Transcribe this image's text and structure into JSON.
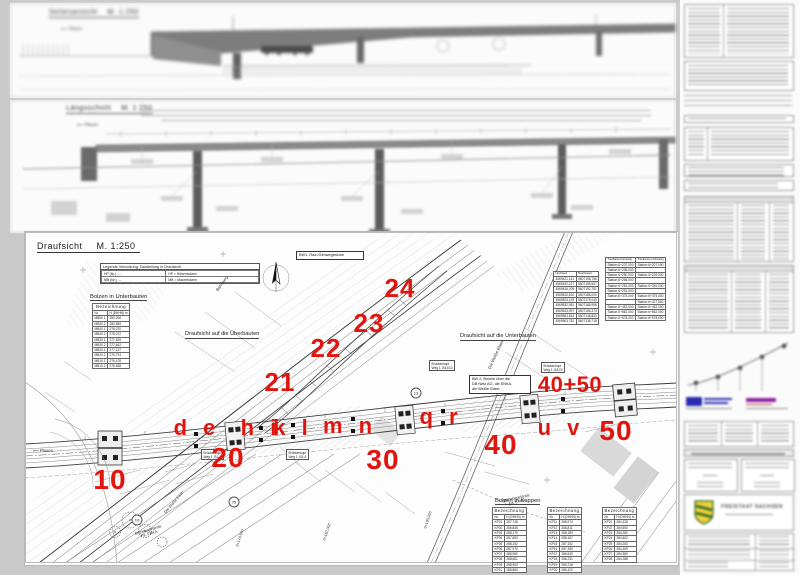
{
  "colors": {
    "red": "#e2140e",
    "paper": "#fbfbfb",
    "line": "#444444",
    "shield_green": "#2d6b1e",
    "shield_yellow": "#f0d040",
    "logo_blue": "#2b2bb0",
    "logo_purple": "#8a1f9e"
  },
  "sheet_side": {
    "title": "Seitenansicht",
    "scale": "M. 1:250",
    "direction": "Plauen"
  },
  "sheet_long": {
    "title": "Längsschnitt",
    "scale": "M. 1:250",
    "direction": "Plauen"
  },
  "plan": {
    "title": "Draufsicht",
    "scale": "M. 1:250",
    "legend": {
      "title": "Legende Verbolzung: Darstellung in Draufsicht",
      "rows": [
        [
          "HP (Nr.) .....",
          "HP   =   Höhenbolzen"
        ],
        [
          "MB (Nr.) .....",
          "MB   =   Mauerbolzen"
        ]
      ]
    },
    "bolzen_unterbauten": {
      "title": "Bolzen in Unterbauten",
      "header": "Bezeichnung",
      "col_nr": "Nr.",
      "col_h": "H (DHHN) m",
      "rows": [
        [
          "MB50.1",
          "280,208"
        ],
        [
          "MB50.2",
          "280,555"
        ],
        [
          "MB40.1",
          "278,070"
        ],
        [
          "MB40.2",
          "278,072"
        ],
        [
          "MB30.1",
          "277,629"
        ],
        [
          "MB30.2",
          "277,642"
        ],
        [
          "MB20.1",
          "277,137"
        ],
        [
          "MB20.2",
          "276,724"
        ],
        [
          "MB10.1",
          "276,478"
        ],
        [
          "MB10.2",
          "276,638"
        ]
      ]
    },
    "bolzen_kappen": {
      "title": "Bolzen in Kappen",
      "tables": [
        {
          "header": "Bezeichnung",
          "col_nr": "Nr.",
          "col_h": "H (DHHN) m",
          "rows": [
            [
              "KP01",
              "287,748"
            ],
            [
              "KP02",
              "286,845"
            ],
            [
              "KP03",
              "288,175"
            ],
            [
              "KP04",
              "287,853"
            ],
            [
              "KP05",
              "288,192"
            ],
            [
              "KP06",
              "287,970"
            ],
            [
              "KP07",
              "288,980"
            ],
            [
              "KP08",
              "288,661"
            ],
            [
              "KP09",
              "288,963"
            ],
            [
              "KP10",
              "288,860"
            ]
          ]
        },
        {
          "header": "Bezeichnung",
          "col_nr": "Nr.",
          "col_h": "H (DHHN) m",
          "rows": [
            [
              "KP11",
              "288,974"
            ],
            [
              "KP12",
              "288,811"
            ],
            [
              "KP13",
              "288,180"
            ],
            [
              "KP14",
              "288,167"
            ],
            [
              "KP15",
              "287,152"
            ],
            [
              "KP16",
              "287,350"
            ],
            [
              "KP17",
              "286,530"
            ],
            [
              "KP18",
              "286,231"
            ],
            [
              "KP19",
              "285,218"
            ],
            [
              "KP20",
              "285,420"
            ]
          ]
        },
        {
          "header": "Bezeichnung",
          "col_nr": "Nr.",
          "col_h": "H (DHHN) m",
          "rows": [
            [
              "KP21",
              "284,328"
            ],
            [
              "KP22",
              "284,550"
            ],
            [
              "KP23",
              "284,280"
            ],
            [
              "KP24",
              "284,502"
            ],
            [
              "KP25",
              "284,283"
            ],
            [
              "KP26",
              "284,309"
            ],
            [
              "KP27",
              "284,380"
            ],
            [
              "KP28",
              "284,288"
            ]
          ]
        }
      ]
    },
    "labels": {
      "view_ueber": "Draufsicht auf die Überbauten",
      "view_unter": "Draufsicht auf die Unterbauten",
      "bw1": "BW1, Rad-/Gehwegbrücke",
      "bw2": "BW 2, Brücke über die\nDB Netz AG, die ENKA,\ndie Weiße Elster",
      "bahnweg": "Bahnweg",
      "elster": "Die Weiße Elster",
      "elster2": "Die Weiße Elster",
      "enka": "Betriebsgelände\nFa. ENKA",
      "enka2": "Betriebsgelände\nFa. ENKA",
      "plauen": "Plauen",
      "bk1": "Brückenkopf\nWeg 1, B1-5",
      "bk2": "Brückenkopf\nWeg 1, B3-4",
      "bk3": "Brückenkopf\nWeg 1, B41/10",
      "bk4": "Brückenkopf\nWeg 1, B41/2",
      "stations": [
        "6+174,650",
        "6+182,000",
        "6+193,000"
      ],
      "circled": [
        "10",
        "75",
        "13"
      ]
    },
    "mini_tables": {
      "coords": {
        "cols": [
          "Hochwert",
          "Rechtswert"
        ],
        "rows": [
          [
            "4569421,141",
            "5607198,758"
          ],
          [
            "4569430,217",
            "5607195,967"
          ],
          [
            "4569436,209",
            "5607192,781"
          ],
          [
            "4569510,810",
            "5607188,000"
          ],
          [
            "4569523,193",
            "5607179,040"
          ],
          [
            "4569532,981",
            "5607168,996"
          ],
          [
            "4569543,997",
            "5607156,374"
          ],
          [
            "4569553,543",
            "5607148,853"
          ],
          [
            "4569563,781",
            "5607138,718"
          ]
        ]
      },
      "stations": {
        "cols": [
          "Traufkante linksseitig",
          "Traufkante rechtsseitig"
        ],
        "rows": [
          [
            "Station 6+207,000",
            "Station 6+207,000"
          ],
          [
            "Station 6+236,000",
            ""
          ],
          [
            "Station 6+250,000",
            "Station 6+239,000"
          ],
          [
            "Station 6+265,000",
            ""
          ],
          [
            "Station 6+281,000",
            "Station 6+281,000"
          ],
          [
            "Station 6+291,000",
            ""
          ],
          [
            "Station 6+375,000",
            "Station 6+375,000"
          ],
          [
            "",
            "Station 6+427,500"
          ],
          [
            "Station 6+452,000",
            "Station 6+452,000"
          ],
          [
            "Station 6+562,000",
            "Station 6+562,000"
          ],
          [
            "Station 6+578,000",
            "Station 6+578,000"
          ]
        ]
      }
    }
  },
  "annotations": {
    "n10": "10",
    "n20": "20",
    "n21": "21",
    "n22": "22",
    "n23": "23",
    "n24": "24",
    "n30": "30",
    "n40": "40",
    "n4050": "40+50",
    "n50": "50",
    "de": "d e",
    "hi": "h i",
    "kl": "k l",
    "mn": "m n",
    "qr": "q r",
    "uv": "u v"
  },
  "titleblock": {
    "state": "FREISTAAT SACHSEN"
  }
}
